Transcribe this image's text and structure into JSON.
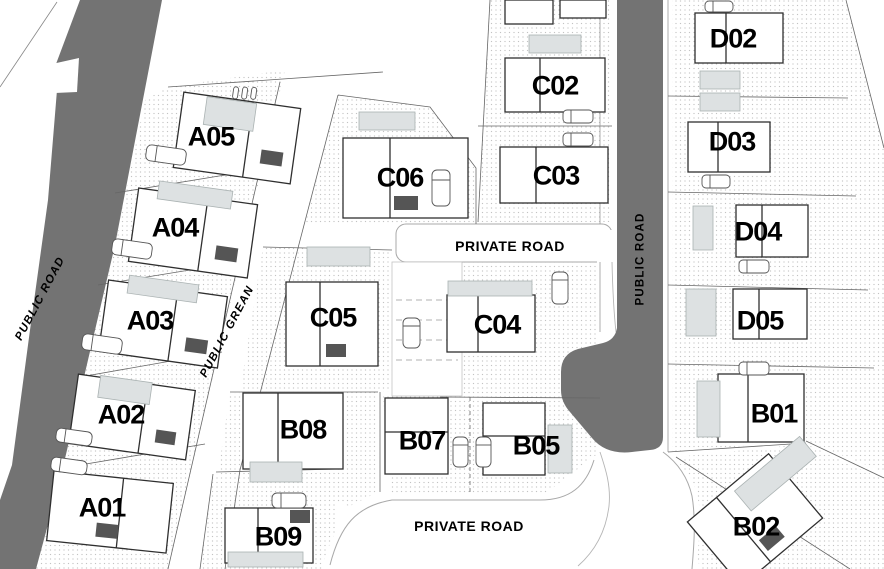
{
  "plots": {
    "A01": "A01",
    "A02": "A02",
    "A03": "A03",
    "A04": "A04",
    "A05": "A05",
    "B01": "B01",
    "B02": "B02",
    "B05": "B05",
    "B07": "B07",
    "B08": "B08",
    "B09": "B09",
    "C02": "C02",
    "C03": "C03",
    "C04": "C04",
    "C05": "C05",
    "C06": "C06",
    "D02": "D02",
    "D03": "D03",
    "D04": "D04",
    "D05": "D05"
  },
  "roads": {
    "public_road_left": "PUBLIC ROAD",
    "public_road_right": "PUBLIC ROAD",
    "public_green_strip": "PUBLIC GREAN",
    "private_road_top": "PRIVATE ROAD",
    "private_road_bottom": "PRIVATE ROAD"
  },
  "colors": {
    "road_fill": "#737373",
    "label_text": "#000000",
    "pool_fill": "#dde1e2",
    "stipple_dot": "#c3c3c3"
  }
}
